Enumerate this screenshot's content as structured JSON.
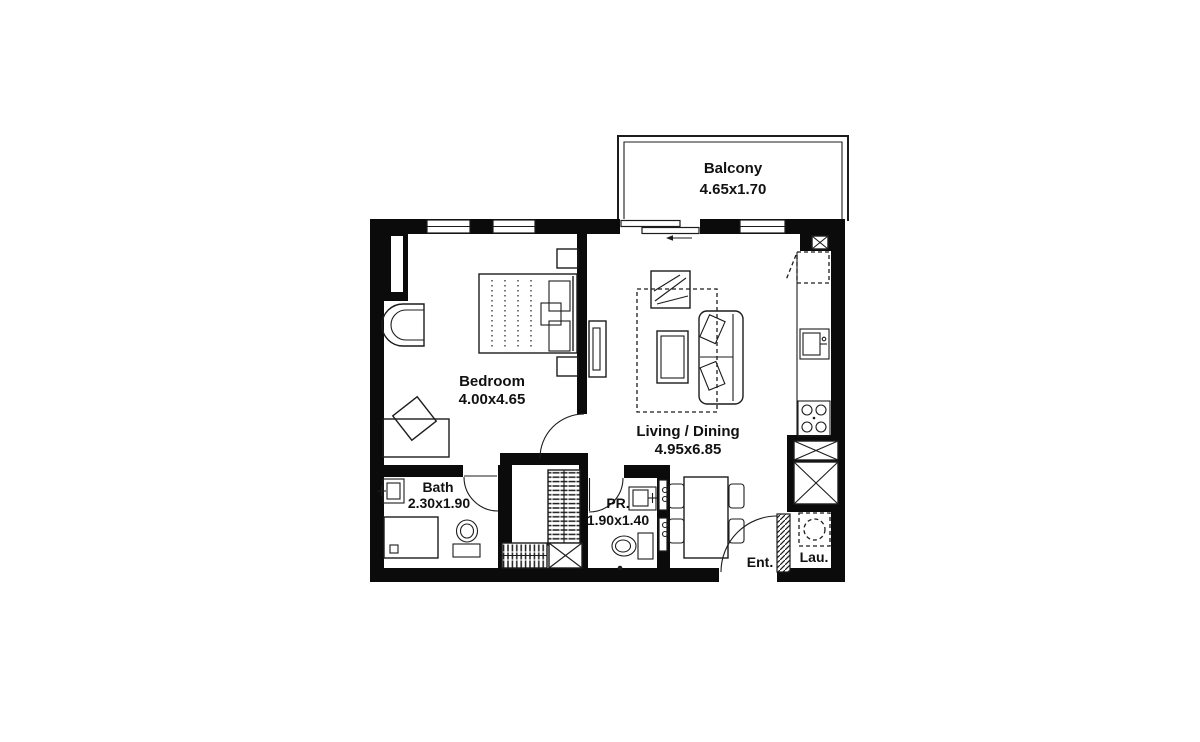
{
  "rooms": {
    "balcony": {
      "name": "Balcony",
      "dims": "4.65x1.70"
    },
    "bedroom": {
      "name": "Bedroom",
      "dims": "4.00x4.65"
    },
    "living_dining": {
      "name": "Living / Dining",
      "dims": "4.95x6.85"
    },
    "bath": {
      "name": "Bath",
      "dims": "2.30x1.90"
    },
    "powder_room": {
      "name": "PR.",
      "dims": "1.90x1.40"
    },
    "entrance": {
      "name": "Ent."
    },
    "laundry": {
      "name": "Lau."
    }
  },
  "colors": {
    "wall": "#0b0b0b",
    "line": "#1c1c1c",
    "background": "#ffffff"
  }
}
